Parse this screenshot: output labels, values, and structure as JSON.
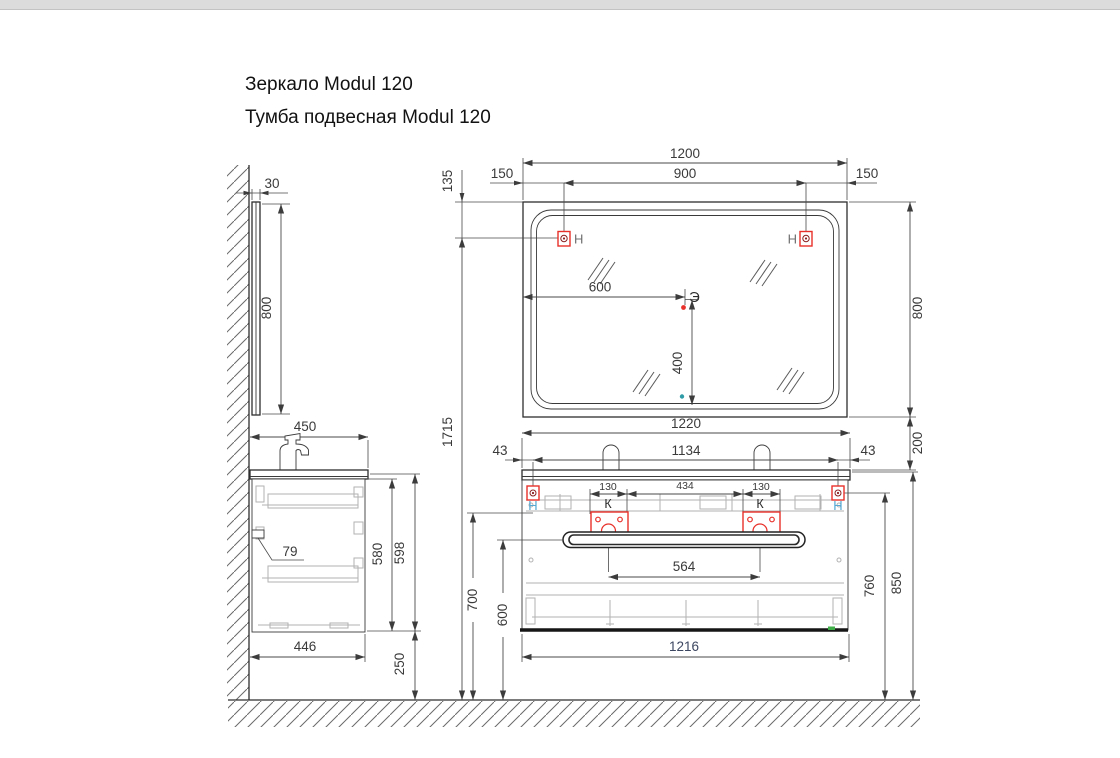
{
  "page": {
    "title_line1": "Зеркало Modul 120",
    "title_line2": "Тумба подвесная Modul 120"
  },
  "labels": {
    "hanger": "Н",
    "power": "Э",
    "drain": "К"
  },
  "colors": {
    "accent_red": "#e8302a",
    "hanger_blue": "#55a8d4",
    "power_dot_red": "#e8302a",
    "sensor_teal": "#2f9ba6",
    "green_mark": "#3fae49",
    "line_dark": "#2e2e2e",
    "detail_gray": "#b2b2b2"
  },
  "dims": {
    "mirror_width": "1200",
    "mirror_hanger_span": "900",
    "mirror_margin_left": "150",
    "mirror_margin_right": "150",
    "mirror_top_to_hanger": "135",
    "mirror_height": "800",
    "mirror_center_offset_x": "600",
    "mirror_center_offset_y": "400",
    "mirror_thickness": "30",
    "mirror_side_height": "800",
    "total_height": "1715",
    "mirror_to_vanity_gap": "200",
    "vanity_depth": "450",
    "vanity_inner_height": "580",
    "vanity_side_height": "598",
    "vanity_bottom_depth": "446",
    "floor_clearance": "250",
    "wall_bracket_offset": "79",
    "vanity_top_width": "1220",
    "vanity_hanger_span": "1134",
    "vanity_margin_left": "43",
    "vanity_margin_right": "43",
    "drain_left_width": "130",
    "drain_spacing": "434",
    "drain_right_width": "130",
    "drain_center_span": "564",
    "hanger_height_left": "700",
    "handle_height": "600",
    "hanger_height_right": "760",
    "vanity_top_height": "850",
    "vanity_width": "1216"
  }
}
